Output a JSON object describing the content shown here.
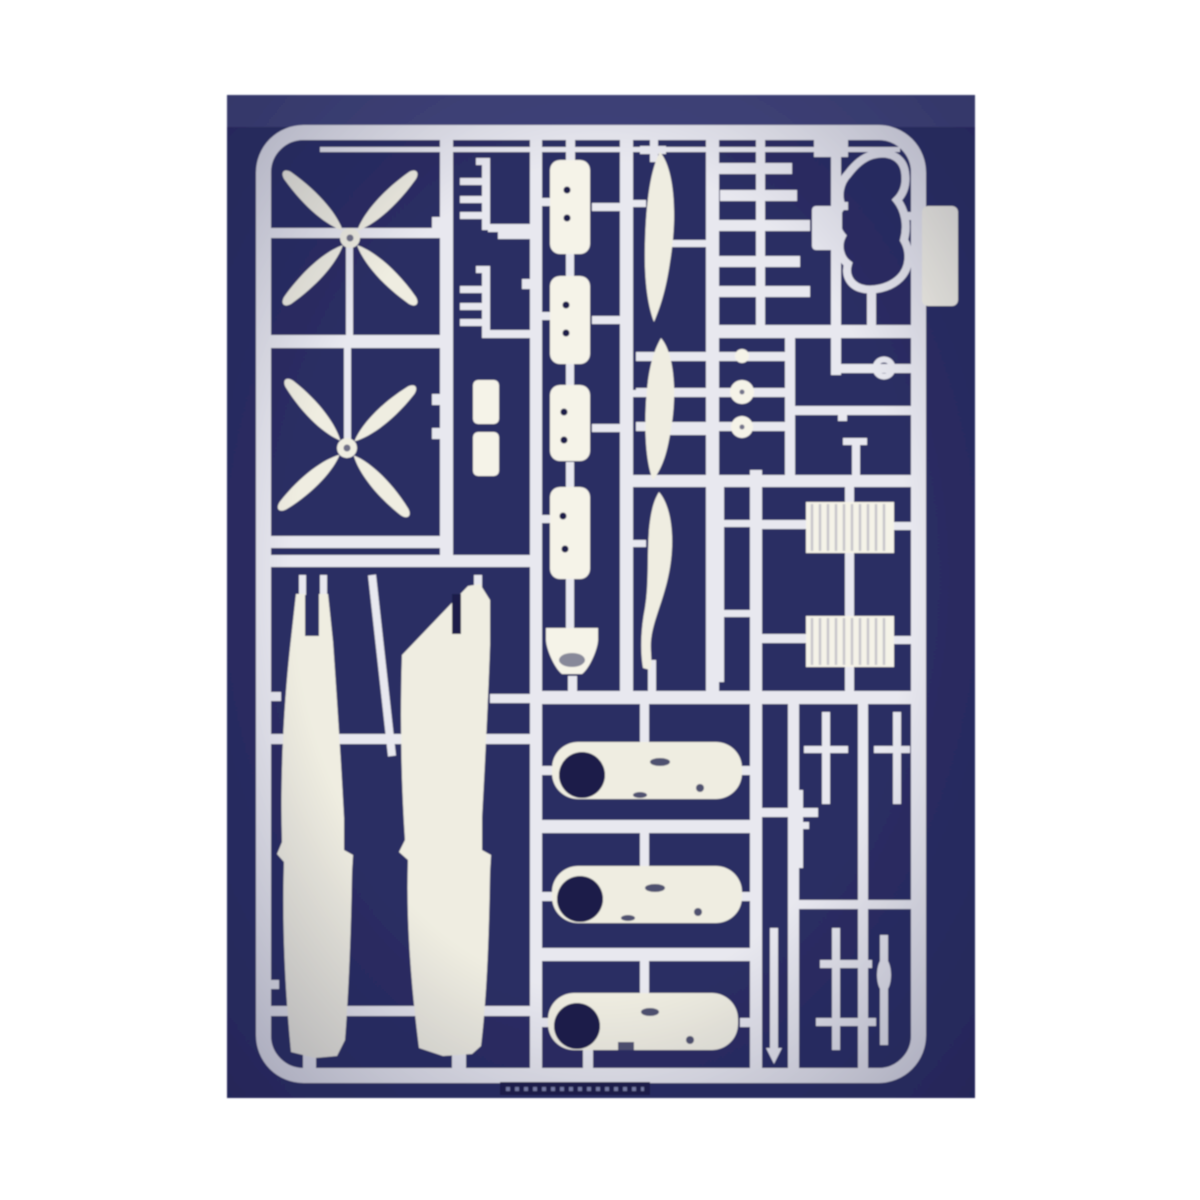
{
  "scene": {
    "subject": "Plastic model kit sprue of white aircraft parts on a dark blue background",
    "description": "A single injection-moulded runner (sprue) of cream-white polystyrene aircraft model parts photographed against a dark indigo surface. The rectangular sprue frame with rounded corners holds two four-blade propellers, two long fuselage halves, four riveted bomb/float bodies, three loose propeller blades, three engine nacelle halves with dark round openings, wheels, two hatched radiator blocks, a canopy frame outline, antenna rakes, numerous struts and rods, and a small moulding tab on the right edge."
  },
  "colors": {
    "page_background": "#ffffff",
    "mat": "#2a2d63",
    "mat_top_band": "#5b6094",
    "mat_deep": "#191c45",
    "frame_plastic": "#e8e8ef",
    "part_plastic": "#efede1",
    "bright_plastic": "#f5f3e8",
    "dark_detail": "#1a1d49",
    "hatch": "#a2a2b2",
    "emboss_dots": "#7f84ad"
  },
  "sprue": {
    "parts_inventory": [
      {
        "part": "four-blade propeller",
        "quantity": 2
      },
      {
        "part": "fuselage half",
        "quantity": 2
      },
      {
        "part": "bomb / float body (riveted)",
        "quantity": 4
      },
      {
        "part": "single propeller blade",
        "quantity": 3
      },
      {
        "part": "engine nacelle half",
        "quantity": 3
      },
      {
        "part": "wheel / disc",
        "quantity": 3
      },
      {
        "part": "radiator block",
        "quantity": 2
      },
      {
        "part": "canopy frame outline",
        "quantity": 1
      },
      {
        "part": "antenna rake",
        "quantity": 2
      },
      {
        "part": "small stores box",
        "quantity": 2
      },
      {
        "part": "strut / rod",
        "quantity": 12
      },
      {
        "part": "moulding label tab",
        "quantity": 1
      }
    ]
  }
}
